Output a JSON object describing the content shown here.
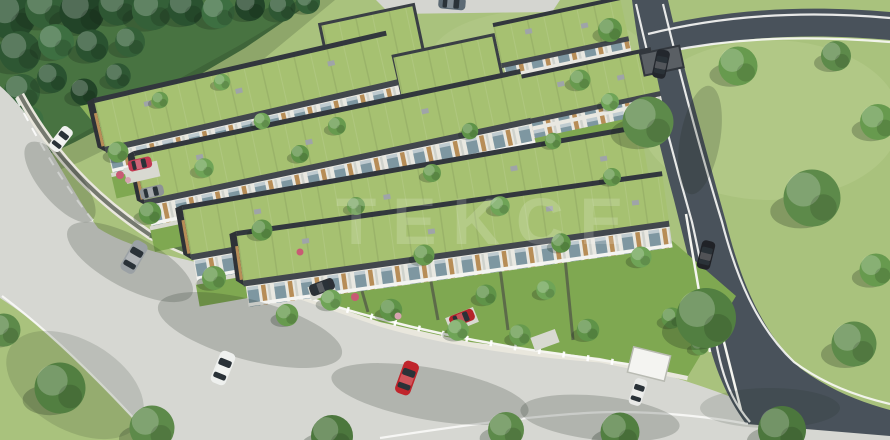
{
  "watermark": {
    "text": "TEKCE",
    "color": "#ffffff"
  },
  "palette": {
    "field_grass": "#a9c27d",
    "estate_lawn": "#7fa851",
    "forest_green": "#2e5733",
    "tree_green": "#679a4e",
    "roof_green": "#a6c171",
    "roof_fascia": "#3a3f45",
    "facade_light": "#e9e8e1",
    "facade_dark": "#54595e",
    "wood_accent": "#b78d57",
    "glass_blue": "#7e97a1",
    "road_concrete": "#d6d7d2",
    "road_asphalt": "#49525b",
    "sidewalk": "#e9e7dd",
    "fence_white": "#f5f5f0",
    "car_red": "#c0252c",
    "car_white": "#f1f2f0",
    "car_silver": "#9ba1a5",
    "car_dark": "#23272d"
  }
}
